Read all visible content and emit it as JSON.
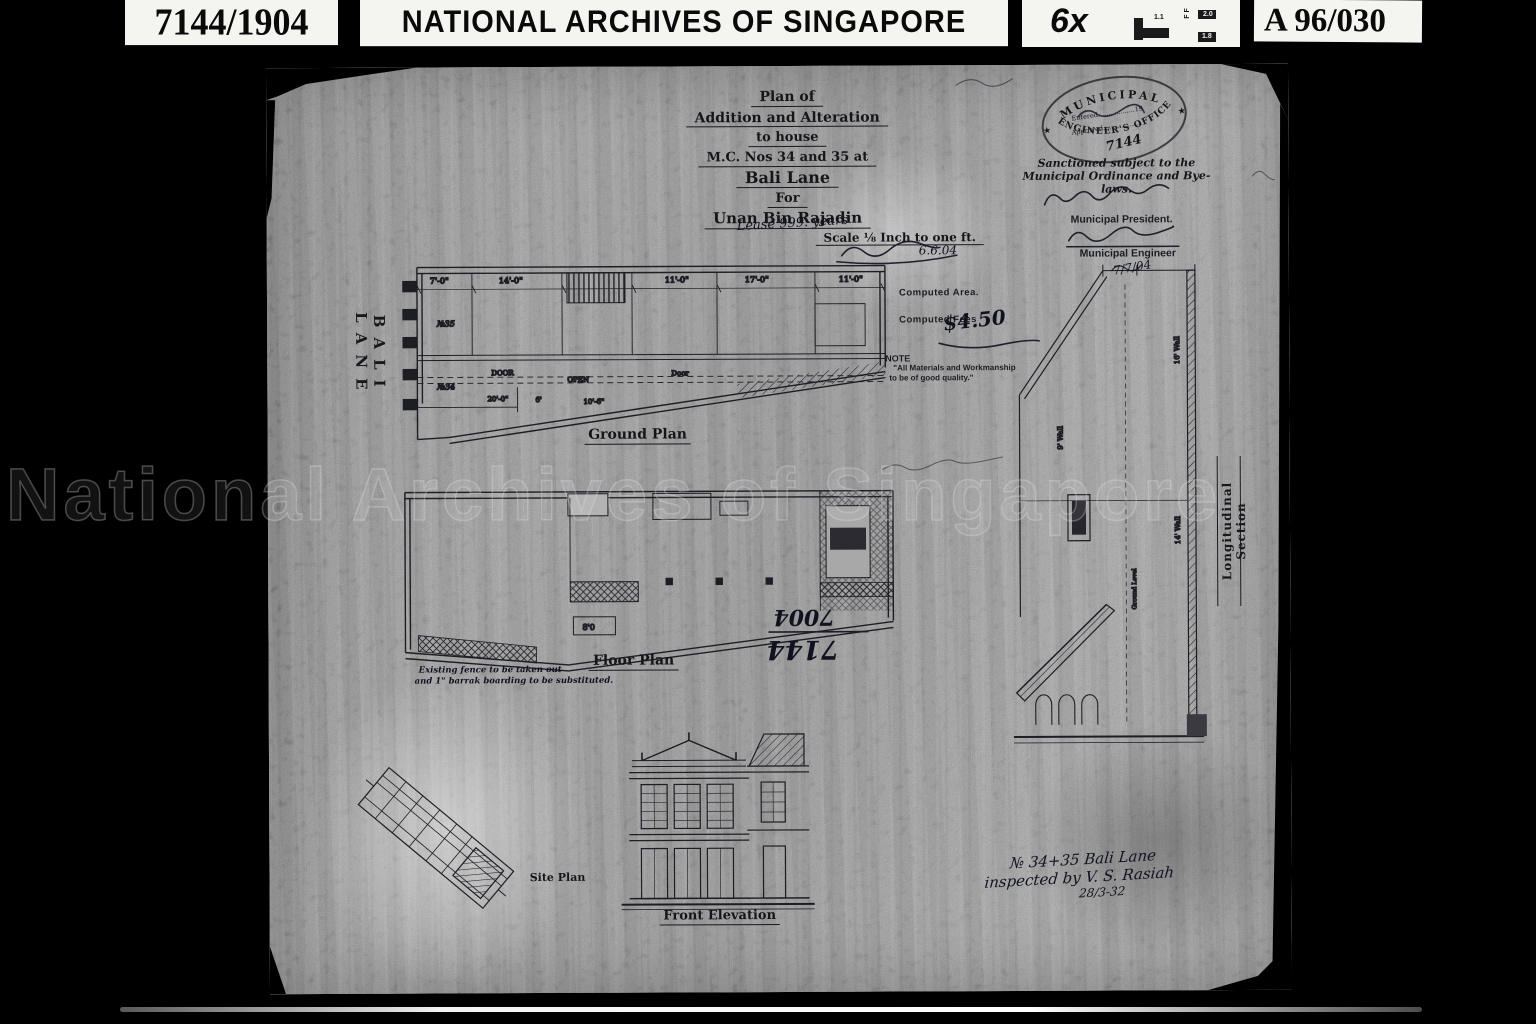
{
  "header": {
    "ref_left": "7144/1904",
    "title": "NATIONAL ARCHIVES OF SINGAPORE",
    "magnification": "6x",
    "ref_right": "A 96/030",
    "target_values": [
      "1.1",
      "F F",
      "2.0",
      "1.8"
    ]
  },
  "watermark": {
    "text": "National Archives of Singapore"
  },
  "street_label": "BALI LANE",
  "title_block": {
    "line1": "Plan of",
    "line2": "Addition and Alteration",
    "line3": "to house",
    "line4": "M.C. Nos 34 and 35 at",
    "line5": "Bali Lane",
    "line6": "For",
    "line7": "Unan Bin Rajadin",
    "line8": "Scale ⅛ Inch to one ft."
  },
  "stamp": {
    "arc_top": "MUNICIPAL",
    "arc_bottom": "ENGINEER'S OFFICE",
    "star": "★",
    "entered": "Entered..................19",
    "approved": "Approved...................",
    "number": "7144"
  },
  "sanction": {
    "line1": "Sanctioned subject to the",
    "line2": "Municipal Ordinance and Bye-laws."
  },
  "officials": {
    "president_label": "Municipal President.",
    "engineer_label": "Municipal Engineer",
    "engineer_date": "7/7/04"
  },
  "annotations": {
    "lease": "Lease 999. years",
    "lease_date": "6.6.04",
    "computed_area_label": "Computed Area.",
    "computed_fees_label": "Computed Fees",
    "fees_value": "$4.50",
    "note_title": "NOTE",
    "note_line1": "\"All Materials and Workmanship",
    "note_line2": "to be of good quality.\"",
    "plan_number_top": "7004",
    "plan_number_bottom": "7144",
    "inspection_line1": "№ 34+35 Bali Lane",
    "inspection_line2": "inspected by V. S. Rasiah",
    "inspection_date": "28/3-32",
    "floor_note_line1": "Existing fence to be taken out",
    "floor_note_line2": "and 1\" barrak boarding to be substituted."
  },
  "plans": {
    "ground": {
      "label": "Ground Plan",
      "dims": [
        "7'-0\"",
        "14'-0\"",
        "11'-0\"",
        "17'-0\"",
        "11'-0\""
      ],
      "rooms": [
        "№35",
        "№34",
        "DOOR",
        "OPEN",
        "Door",
        "20'-0\"",
        "6'",
        "10'-6\""
      ]
    },
    "floor": {
      "label": "Floor Plan",
      "dim": "8'0"
    },
    "site": {
      "label": "Site Plan"
    },
    "elevation": {
      "label": "Front Elevation"
    },
    "section": {
      "label": "Longitudinal Section",
      "walls": [
        "16' Wall",
        "9' Wall",
        "14' Wall",
        "Ground Level"
      ]
    }
  }
}
